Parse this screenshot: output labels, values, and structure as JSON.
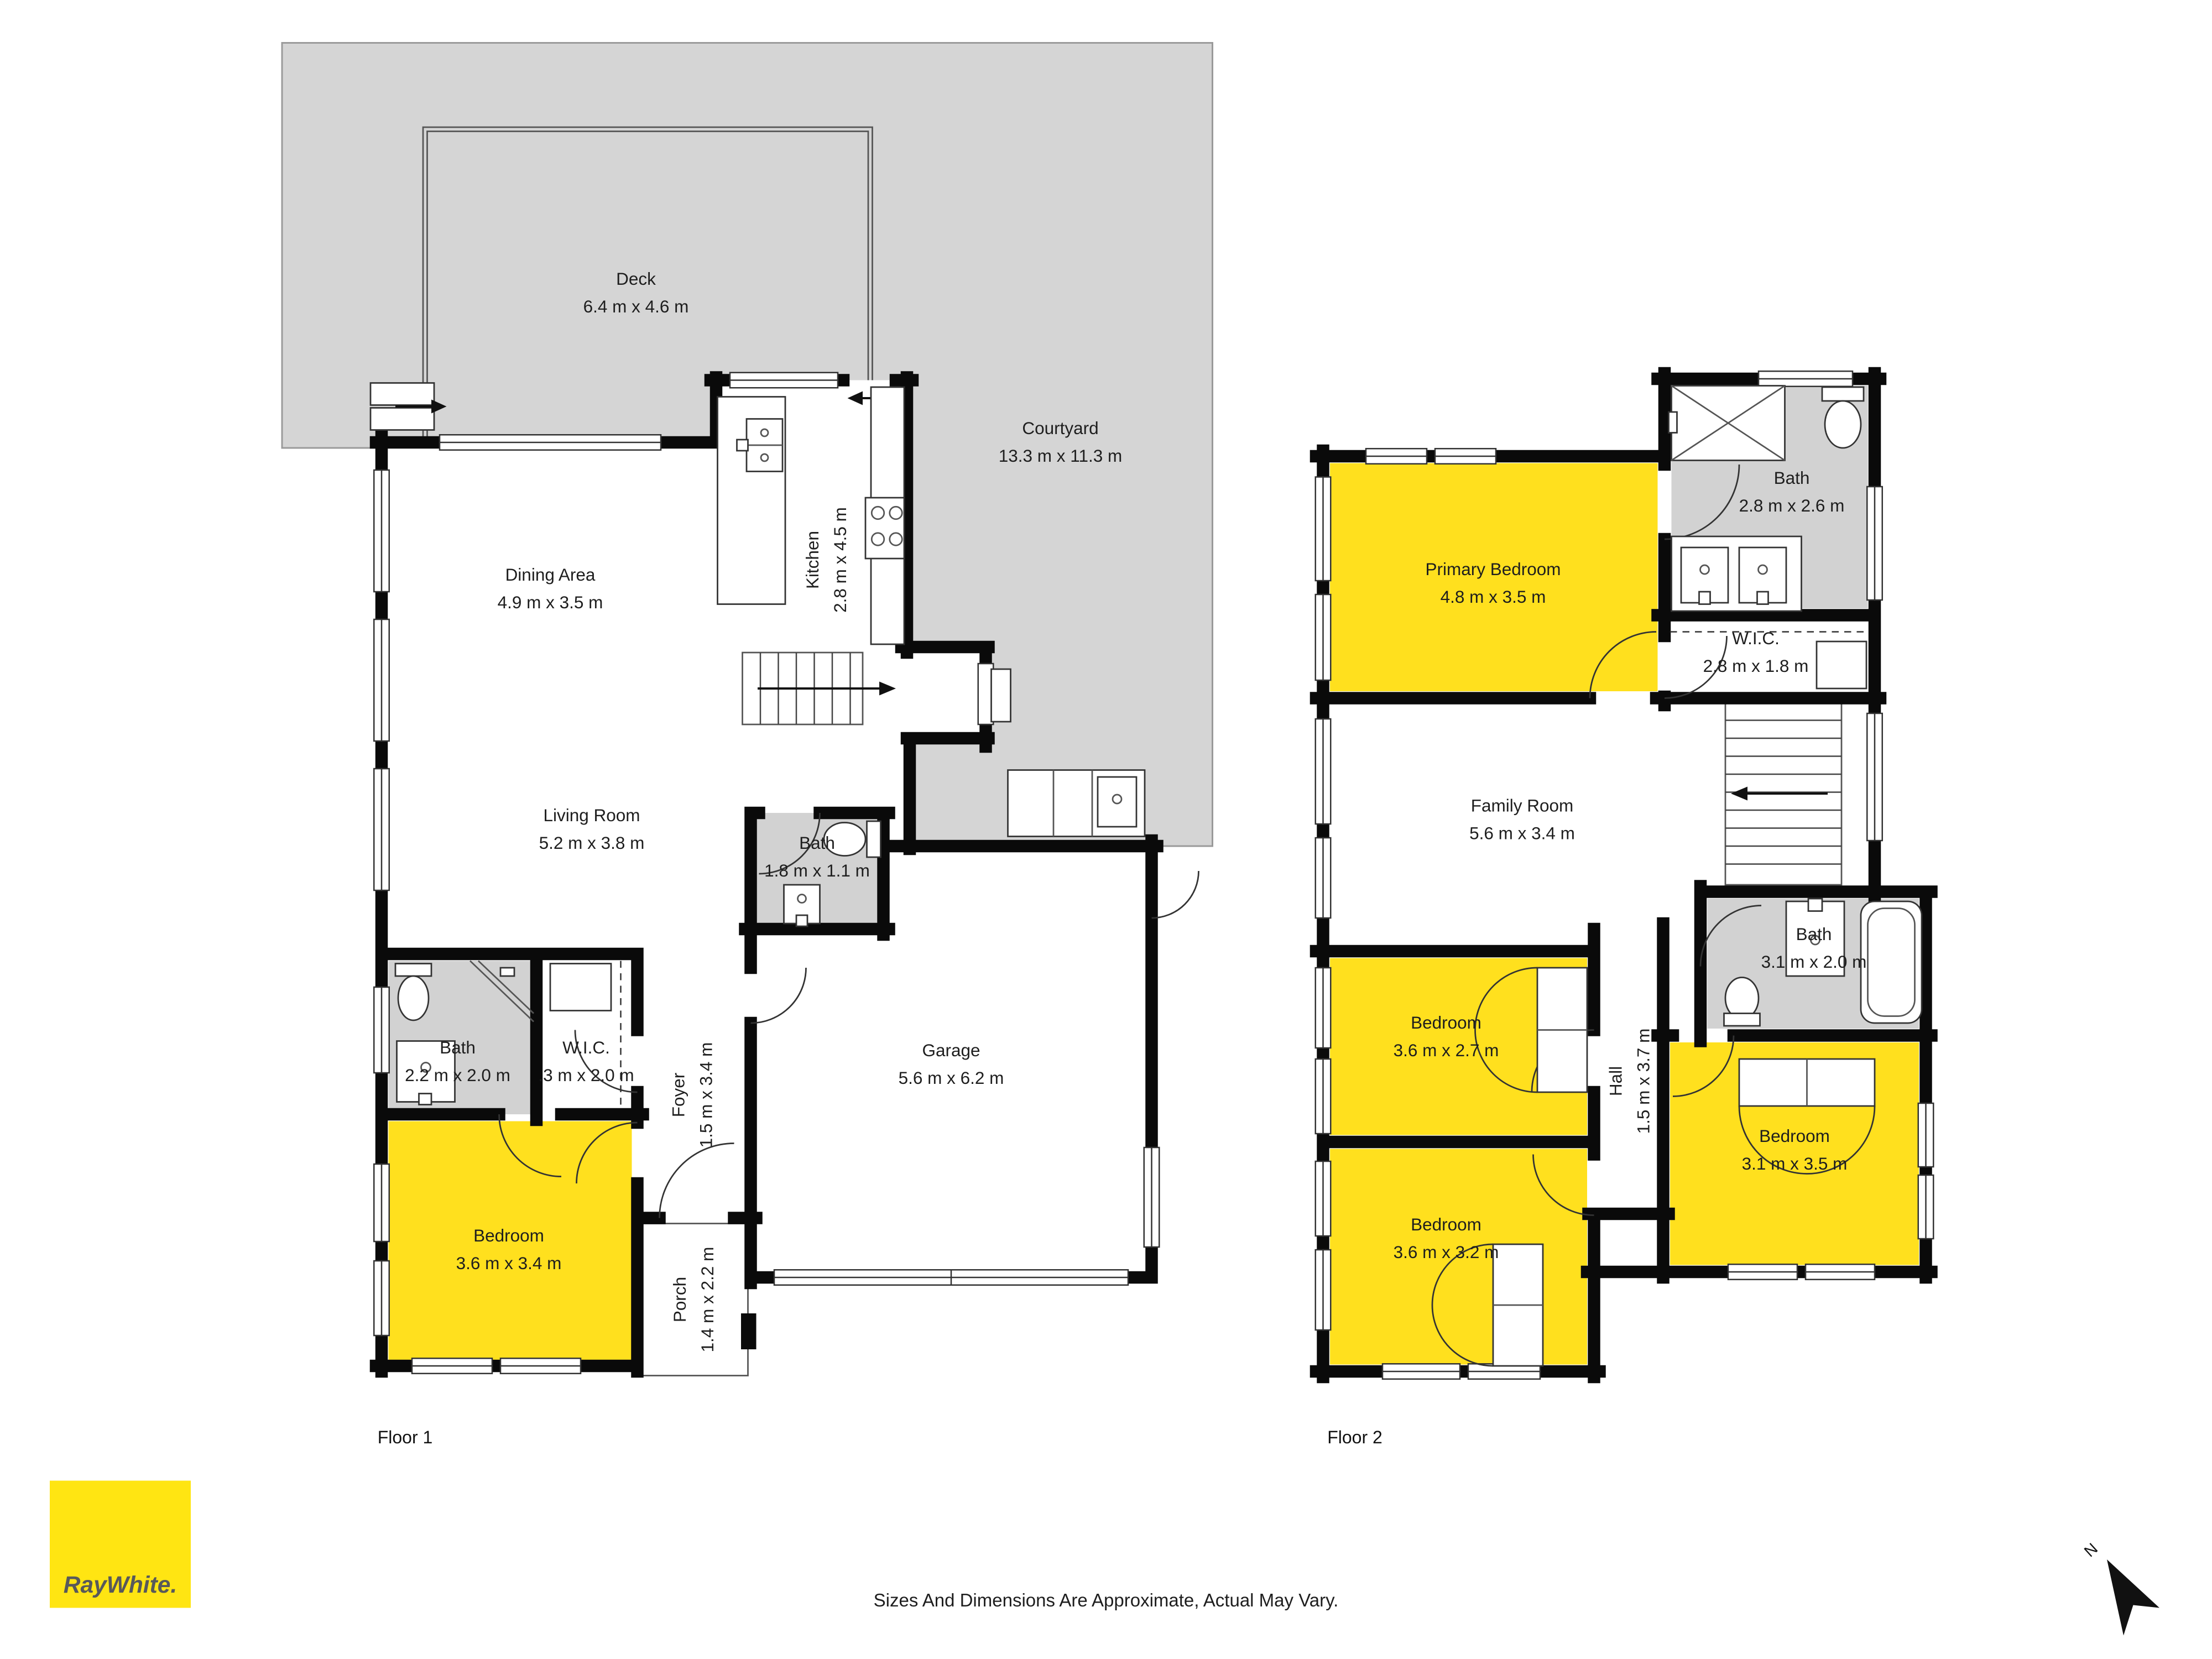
{
  "colors": {
    "room_yellow": "#ffe01e",
    "outdoor_gray": "#d5d5d5",
    "bath_gray": "#d2d2d2",
    "wall_black": "#0a0a0a",
    "logo_yellow": "#ffe512",
    "logo_text_gray": "#58595B"
  },
  "floor1": {
    "label": "Floor 1",
    "rooms": {
      "deck": {
        "name": "Deck",
        "dims": "6.4 m x 4.6 m"
      },
      "courtyard": {
        "name": "Courtyard",
        "dims": "13.3 m x 11.3 m"
      },
      "dining": {
        "name": "Dining Area",
        "dims": "4.9 m x 3.5 m"
      },
      "kitchen": {
        "name": "Kitchen",
        "dims": "2.8 m x 4.5 m"
      },
      "living": {
        "name": "Living Room",
        "dims": "5.2 m x 3.8 m"
      },
      "bath_upper": {
        "name": "Bath",
        "dims": "1.8 m x 1.1 m"
      },
      "garage": {
        "name": "Garage",
        "dims": "5.6 m x 6.2 m"
      },
      "bath_lower": {
        "name": "Bath",
        "dims": "2.2 m x 2.0 m"
      },
      "wic": {
        "name": "W.I.C.",
        "dims": ".3 m x 2.0 m"
      },
      "foyer": {
        "name": "Foyer",
        "dims": "1.5 m x 3.4 m"
      },
      "bedroom": {
        "name": "Bedroom",
        "dims": "3.6 m x 3.4 m"
      },
      "porch": {
        "name": "Porch",
        "dims": "1.4 m x 2.2 m"
      }
    }
  },
  "floor2": {
    "label": "Floor 2",
    "rooms": {
      "primary_bedroom": {
        "name": "Primary Bedroom",
        "dims": "4.8 m x 3.5 m"
      },
      "bath_ensuite": {
        "name": "Bath",
        "dims": "2.8 m x 2.6 m"
      },
      "wic": {
        "name": "W.I.C.",
        "dims": "2.8 m x 1.8 m"
      },
      "family_room": {
        "name": "Family Room",
        "dims": "5.6 m x 3.4 m"
      },
      "bath_hall": {
        "name": "Bath",
        "dims": "3.1 m x 2.0 m"
      },
      "bedroom_left": {
        "name": "Bedroom",
        "dims": "3.6 m x 2.7 m"
      },
      "hall": {
        "name": "Hall",
        "dims": "1.5 m x 3.7 m"
      },
      "bedroom_right": {
        "name": "Bedroom",
        "dims": "3.1 m x 3.5 m"
      },
      "bedroom_bottom": {
        "name": "Bedroom",
        "dims": "3.6 m x 3.2 m"
      }
    }
  },
  "footer": {
    "disclaimer": "Sizes And Dimensions Are Approximate, Actual May Vary."
  },
  "brand": {
    "logo_text": "RayWhite."
  },
  "compass": {
    "north_label": "N"
  }
}
